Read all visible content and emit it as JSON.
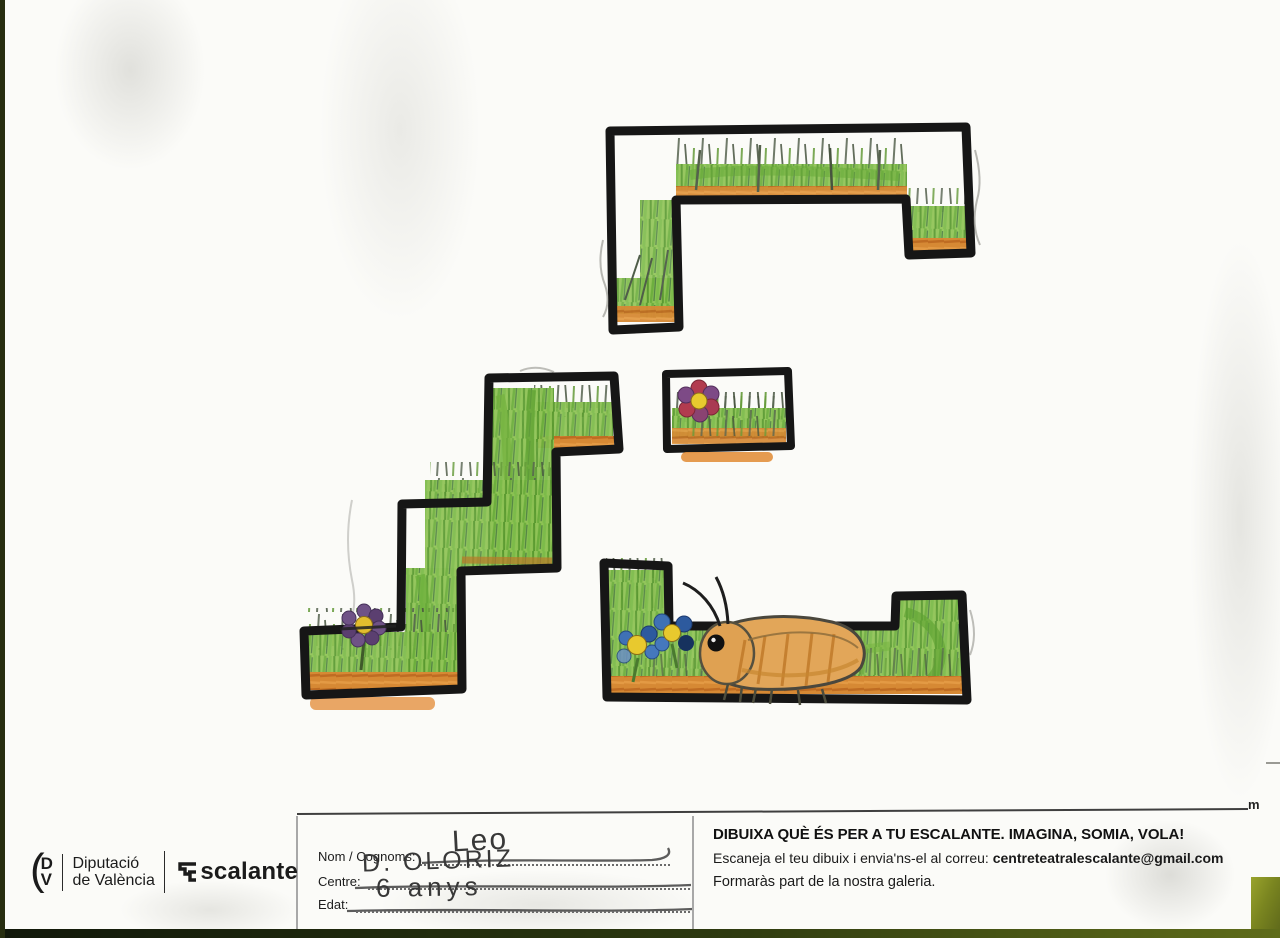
{
  "edge": {
    "mark": "m"
  },
  "footer": {
    "logo": {
      "paren": "(",
      "monogram_top": "D",
      "monogram_bottom": "V",
      "org_line1": "Diputació",
      "org_line2": "de València",
      "brand_rest": "scalante"
    },
    "form": {
      "fields": [
        {
          "label": "Nom / Cognoms:",
          "value": "Leo"
        },
        {
          "label": "Centre:",
          "value": "D. OLORIZ"
        },
        {
          "label": "Edat:",
          "value": "6 anys"
        }
      ]
    },
    "info": {
      "headline": "DIBUIXA QUÈ ÉS PER A TU ESCALANTE. IMAGINA, SOMIA, VOLA!",
      "scan_prefix": "Escaneja el teu dibuix i envia'ns-el al correu: ",
      "email": "centreteatralescalante@gmail.com",
      "gallery": "Formaràs part de la nostra galeria."
    }
  },
  "drawing": {
    "subject": "Child's crayon drawing of the Escalante stairs-E logo as grassy platform levels",
    "elements": [
      "top bridge platform",
      "staircase platform",
      "small flower box",
      "long bottom platform",
      "purple flower",
      "red-purple flower",
      "two blue flowers",
      "orange bug with antennae"
    ],
    "colors": {
      "outline": "#161616",
      "grass": "#8fc355",
      "grass_dark": "#59992f",
      "soil": "#d68934",
      "bug_body": "#e2a659",
      "flower_purple": "#6f5286",
      "flower_red": "#b23b4f",
      "flower_blue": "#3f71b5",
      "flower_center": "#e3bd2e",
      "scanner_olive": "#6b761b"
    }
  }
}
